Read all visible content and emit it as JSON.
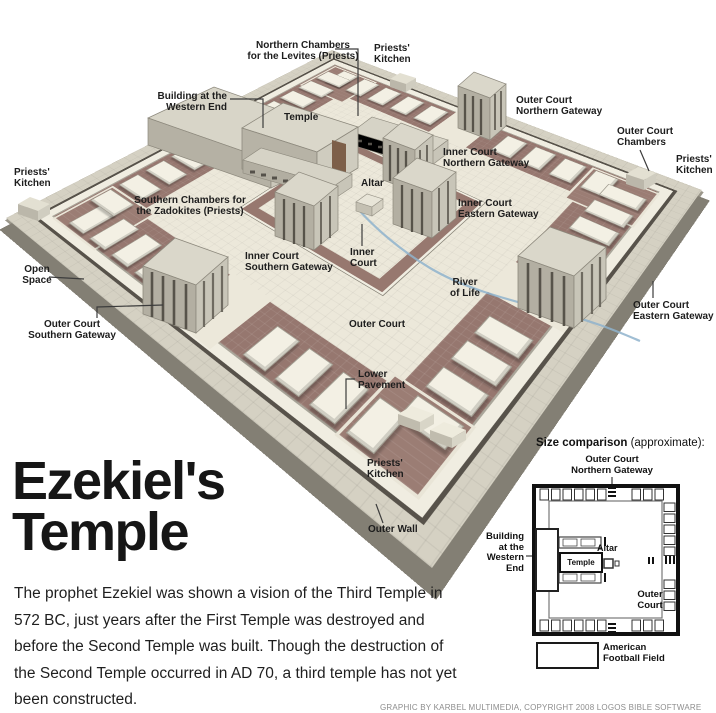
{
  "title": {
    "line1": "Ezekiel's",
    "line2": "Temple"
  },
  "intro": "The prophet Ezekiel was shown a vision of the Third Temple in 572 BC, just years after the First Temple was destroyed and before the Second Temple was built. Though the destruction of the Second Temple occurred in AD 70, a third temple has not yet been constructed.",
  "credit": "GRAPHIC BY KARBEL MULTIMEDIA, COPYRIGHT 2008 LOGOS BIBLE SOFTWARE",
  "colors": {
    "pavement": "#96776f",
    "court": "#ece8da",
    "slab": "#d5d1c3",
    "river": "#8fb3cd",
    "building_top": "#d8d5c8",
    "building_left": "#b5b1a4",
    "building_right": "#cbc8bb",
    "edge": "#57524a"
  },
  "labels": {
    "northern_chambers": {
      "l1": "Northern Chambers",
      "l2": "for the Levites (Priests)"
    },
    "priests_kitchen": {
      "l1": "Priests'",
      "l2": "Kitchen"
    },
    "building_western_end": {
      "l1": "Building at the",
      "l2": "Western End"
    },
    "temple": "Temple",
    "outer_court_northern_gateway": {
      "l1": "Outer Court",
      "l2": "Northern Gateway"
    },
    "outer_court_chambers": {
      "l1": "Outer Court",
      "l2": "Chambers"
    },
    "inner_court_northern_gateway": {
      "l1": "Inner Court",
      "l2": "Northern Gateway"
    },
    "altar": "Altar",
    "inner_court_eastern_gateway": {
      "l1": "Inner Court",
      "l2": "Eastern Gateway"
    },
    "southern_chambers": {
      "l1": "Southern Chambers for",
      "l2": "the Zadokites (Priests)"
    },
    "inner_court_southern_gateway": {
      "l1": "Inner Court",
      "l2": "Southern Gateway"
    },
    "inner_court": {
      "l1": "Inner",
      "l2": "Court"
    },
    "river_of_life": {
      "l1": "River",
      "l2": "of Life"
    },
    "open_space": {
      "l1": "Open",
      "l2": "Space"
    },
    "outer_court_southern_gateway": {
      "l1": "Outer Court",
      "l2": "Southern Gateway"
    },
    "outer_court": "Outer Court",
    "outer_court_eastern_gateway": {
      "l1": "Outer Court",
      "l2": "Eastern Gateway"
    },
    "lower_pavement": {
      "l1": "Lower",
      "l2": "Pavement"
    },
    "outer_wall": "Outer Wall"
  },
  "inset": {
    "title_bold": "Size comparison",
    "title_rest": " (approximate):",
    "outer_court_northern_gateway": {
      "l1": "Outer Court",
      "l2": "Northern Gateway"
    },
    "building_western_end": {
      "l1": "Building",
      "l2": "at the",
      "l3": "Western",
      "l4": "End"
    },
    "temple": "Temple",
    "altar": "Altar",
    "outer_court": {
      "l1": "Outer",
      "l2": "Court"
    },
    "football": {
      "l1": "American",
      "l2": "Football Field"
    }
  }
}
